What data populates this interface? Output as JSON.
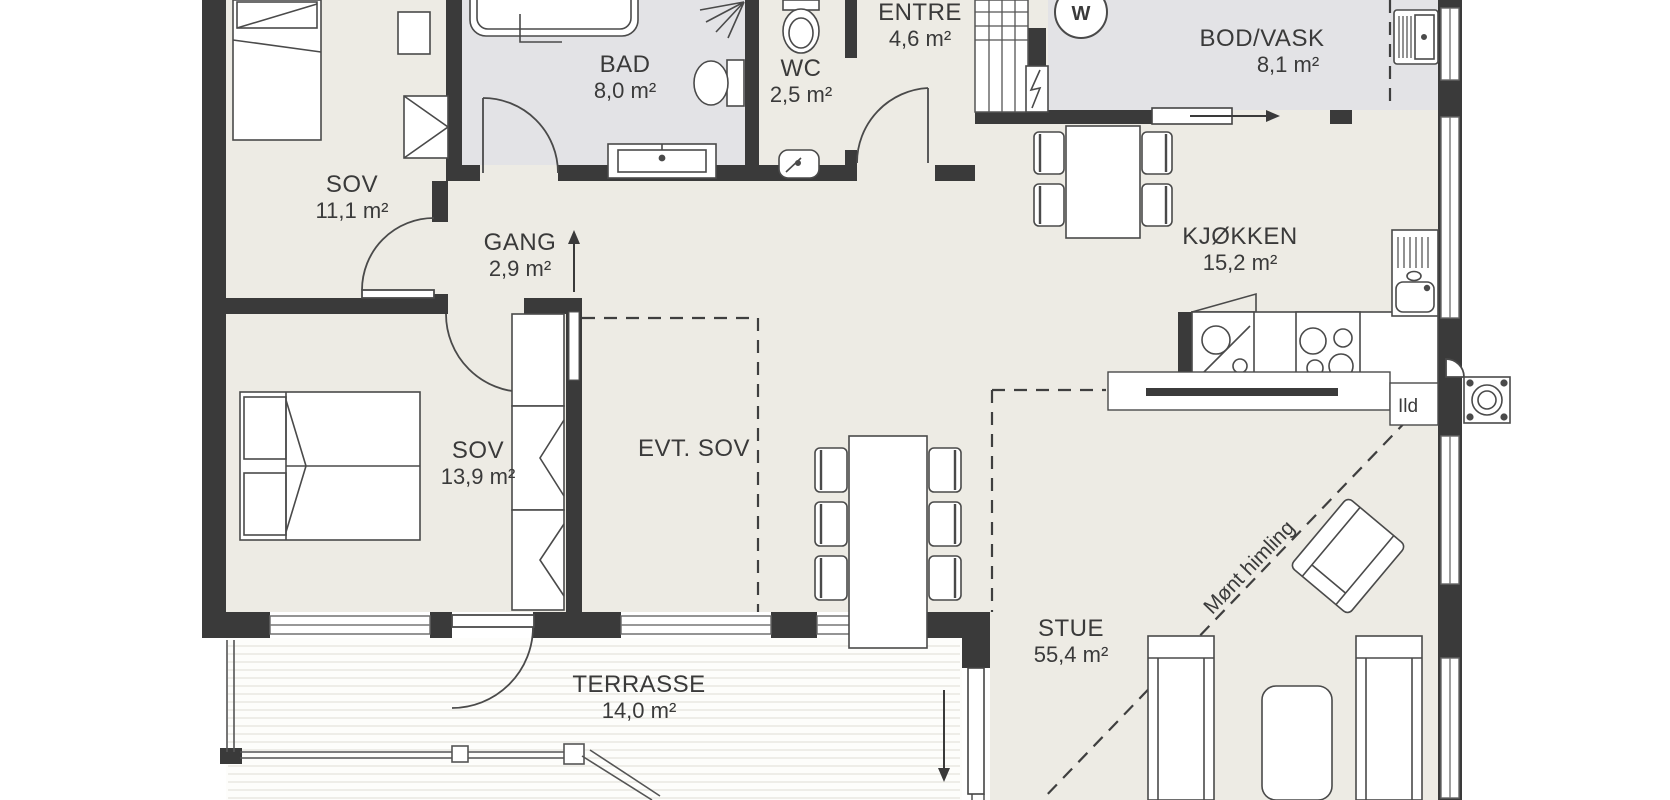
{
  "plan": {
    "rooms": {
      "sov1": {
        "name": "SOV",
        "area": "11,1 m²"
      },
      "bad": {
        "name": "BAD",
        "area": "8,0 m²"
      },
      "wc": {
        "name": "WC",
        "area": "2,5 m²"
      },
      "entre": {
        "name": "ENTRE",
        "area": "4,6 m²"
      },
      "bod_vask": {
        "name": "BOD/VASK",
        "area": "8,1 m²"
      },
      "gang": {
        "name": "GANG",
        "area": "2,9 m²"
      },
      "kjokken": {
        "name": "KJØKKEN",
        "area": "15,2 m²"
      },
      "sov2": {
        "name": "SOV",
        "area": "13,9 m²"
      },
      "evt_sov": {
        "name": "EVT. SOV"
      },
      "stue": {
        "name": "STUE",
        "area": "55,4 m²"
      },
      "terrasse": {
        "name": "TERRASSE",
        "area": "14,0 m²"
      }
    },
    "annotations": {
      "ridge": "Mønt himling",
      "fireplace": "Ild",
      "washer": "W"
    },
    "colors": {
      "wall": "#3a3a3a",
      "floor": "#edebe4",
      "wet_floor": "#e3e3e6",
      "terrace_stripe": "#e9e8e2",
      "text": "#3a3a3a"
    }
  }
}
